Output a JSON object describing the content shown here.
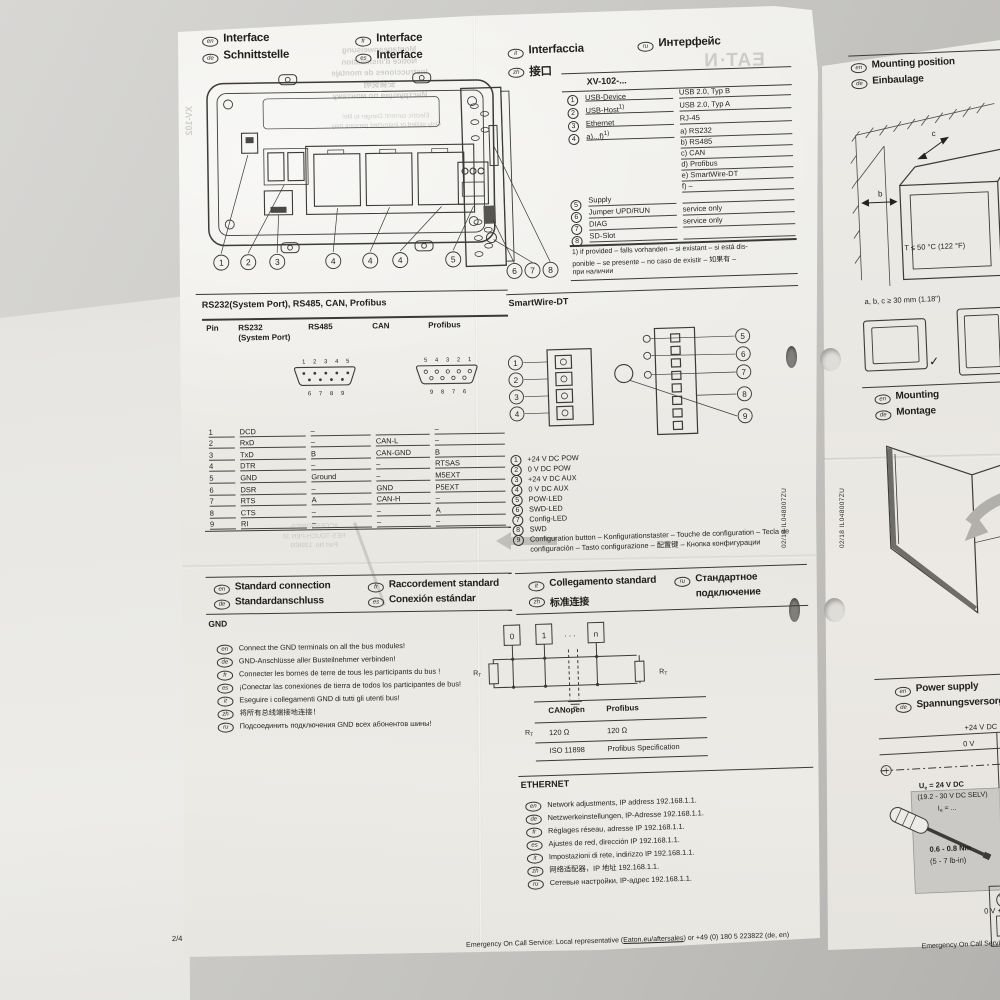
{
  "doc": {
    "code": "02/18 IL048007ZU",
    "page": "2/4",
    "footer": {
      "pre": "Emergency On Call Service: Local representative (",
      "link": "Eaton.eu/aftersales",
      "post": ") or +49 (0) 180 5 223822 (de, en)",
      "right_partial": "Emergency On Call Service: Lo"
    }
  },
  "interface_left": {
    "headers": [
      {
        "lang": "en",
        "text": "Interface"
      },
      {
        "lang": "de",
        "text": "Schnittstelle"
      },
      {
        "lang": "fr",
        "text": "Interface"
      },
      {
        "lang": "es",
        "text": "Interface"
      }
    ],
    "callouts": [
      "1",
      "2",
      "3",
      "4",
      "4",
      "4",
      "5"
    ]
  },
  "interface_mid": {
    "headers": [
      {
        "lang": "it",
        "text": "Interfaccia"
      },
      {
        "lang": "zh",
        "text": "接口"
      },
      {
        "lang": "ru",
        "text": "Интерфейс"
      }
    ],
    "side_callouts": [
      "6",
      "7",
      "8"
    ]
  },
  "xv102": {
    "title": "XV-102-...",
    "rows": [
      {
        "num": "1",
        "label": "USB-Device",
        "sup": "",
        "value": "USB 2.0, Typ B"
      },
      {
        "num": "2",
        "label": "USB-Host",
        "sup": "1)",
        "value": "USB 2.0, Typ A"
      },
      {
        "num": "3",
        "label": "Ethernet",
        "sup": "",
        "value": "RJ-45"
      },
      {
        "num": "4",
        "label": "a)...f)",
        "sup": "1)",
        "value": ""
      },
      {
        "num": "5",
        "label": "Supply",
        "sup": "",
        "value": ""
      },
      {
        "num": "6",
        "label": "Jumper UPD/RUN",
        "sup": "",
        "value": "service only"
      },
      {
        "num": "7",
        "label": "DIAG",
        "sup": "",
        "value": "service only"
      },
      {
        "num": "8",
        "label": "SD-Slot",
        "sup": "",
        "value": ""
      }
    ],
    "options": [
      "a) RS232",
      "b) RS485",
      "c) CAN",
      "d) Profibus",
      "e) SmartWire-DT",
      "f) –"
    ],
    "footnote_lines": [
      "1) if provided – falls vorhanden – si existant – si está dis-",
      "ponible – se presente – no caso de existir – 如果有 –",
      "при наличии"
    ]
  },
  "pin_table": {
    "title": "RS232(System Port), RS485, CAN, Profibus",
    "headers": {
      "pin": "Pin",
      "rs232a": "RS232",
      "rs232b": "(System Port)",
      "rs485": "RS485",
      "can": "CAN",
      "profibus": "Profibus"
    },
    "conn_left_top": [
      "1",
      "2",
      "3",
      "4",
      "5"
    ],
    "conn_left_bottom": [
      "6",
      "7",
      "8",
      "9"
    ],
    "conn_right_top": [
      "5",
      "4",
      "3",
      "2",
      "1"
    ],
    "conn_right_bottom": [
      "9",
      "8",
      "7",
      "6"
    ],
    "rows": [
      [
        "1",
        "DCD",
        "–",
        "",
        "–"
      ],
      [
        "2",
        "RxD",
        "–",
        "CAN-L",
        "–"
      ],
      [
        "3",
        "TxD",
        "B",
        "CAN-GND",
        "B"
      ],
      [
        "4",
        "DTR",
        "–",
        "–",
        "RTSAS"
      ],
      [
        "5",
        "GND",
        "Ground",
        "–",
        "M5EXT"
      ],
      [
        "6",
        "DSR",
        "–",
        "GND",
        "P5EXT"
      ],
      [
        "7",
        "RTS",
        "A",
        "CAN-H",
        "–"
      ],
      [
        "8",
        "CTS",
        "–",
        "–",
        "A"
      ],
      [
        "9",
        "RI",
        "–",
        "–",
        "–"
      ]
    ]
  },
  "smartwire": {
    "title": "SmartWire-DT",
    "left_callouts": [
      "1",
      "2",
      "3",
      "4"
    ],
    "right_callouts": [
      "5",
      "6",
      "7",
      "8",
      "9"
    ],
    "legend": [
      {
        "num": "1",
        "text": "+24 V DC POW"
      },
      {
        "num": "2",
        "text": "0 V DC POW"
      },
      {
        "num": "3",
        "text": "+24 V DC AUX"
      },
      {
        "num": "4",
        "text": "0 V DC AUX"
      },
      {
        "num": "5",
        "text": "POW-LED"
      },
      {
        "num": "6",
        "text": "SWD-LED"
      },
      {
        "num": "7",
        "text": "Config-LED"
      },
      {
        "num": "8",
        "text": "SWD"
      },
      {
        "num": "9",
        "text": "Configuration button – Konfigurationstaster – Touche de configuration – Tecla de configuración – Tasto configurazione – 配置键 – Кнопка конфигурации"
      }
    ]
  },
  "std_conn_left": {
    "headers": [
      {
        "lang": "en",
        "text": "Standard connection"
      },
      {
        "lang": "de",
        "text": "Standardanschluss"
      },
      {
        "lang": "fr",
        "text": "Raccordement standard"
      },
      {
        "lang": "es",
        "text": "Conexión estándar"
      }
    ],
    "gnd": "GND",
    "items": [
      {
        "lang": "en",
        "text": "Connect the GND terminals on all the bus modules!"
      },
      {
        "lang": "de",
        "text": "GND-Anschlüsse aller Busteilnehmer verbinden!"
      },
      {
        "lang": "fr",
        "text": "Connecter les bornes de terre de tous les participants du bus !"
      },
      {
        "lang": "es",
        "text": "¡Conectar las conexiones de tierra de todos los participantes de bus!"
      },
      {
        "lang": "it",
        "text": "Eseguire i collegamenti GND di tutti gli utenti bus!"
      },
      {
        "lang": "zh",
        "text": "将所有总线端接地连接！"
      },
      {
        "lang": "ru",
        "text": "Подсоединить подключения GND всех абонентов шины!"
      }
    ]
  },
  "std_conn_mid": {
    "headers": [
      {
        "lang": "it",
        "text": "Collegamento standard",
        "text2": ""
      },
      {
        "lang": "zh",
        "text": "标准连接",
        "text2": ""
      },
      {
        "lang": "ru",
        "text": "Стандартное",
        "text2": "подключение"
      }
    ]
  },
  "bus": {
    "nodes": [
      "0",
      "1",
      "n"
    ],
    "dots": ". . .",
    "rt": {
      "base": "R",
      "sub": "T"
    },
    "table": {
      "col1": "CANopen",
      "col2": "Profibus",
      "r1c1": "120 Ω",
      "r1c2": "120 Ω",
      "r2c1": "ISO 11898",
      "r2c2": "Profibus Specification"
    }
  },
  "ethernet": {
    "title": "ETHERNET",
    "items": [
      {
        "lang": "en",
        "text": "Network adjustments, IP address 192.168.1.1."
      },
      {
        "lang": "de",
        "text": "Netzwerkeinstellungen, IP-Adresse 192.168.1.1."
      },
      {
        "lang": "fr",
        "text": "Réglages réseau, adresse IP 192.168.1.1."
      },
      {
        "lang": "es",
        "text": "Ajustes de red, dirección IP 192.168.1.1."
      },
      {
        "lang": "it",
        "text": "Impostazioni di rete, indirizzo IP 192.168.1.1."
      },
      {
        "lang": "zh",
        "text": "网络适配器，IP 地址 192.168.1.1."
      },
      {
        "lang": "ru",
        "text": "Сетевые настройки, IP-адрес 192.168.1.1."
      }
    ]
  },
  "mounting_pos": {
    "headers": [
      {
        "lang": "en",
        "text": "Mounting position"
      },
      {
        "lang": "de",
        "text": "Einbaulage"
      }
    ],
    "temp": "T ≤ 50 °C (122 °F)",
    "dims": "a, b, c ≥ 30 mm (1.18\")",
    "label_b": "b",
    "label_c": "c",
    "check": "✓"
  },
  "mounting": {
    "headers": [
      {
        "lang": "en",
        "text": "Mounting"
      },
      {
        "lang": "de",
        "text": "Montage"
      }
    ]
  },
  "power": {
    "headers": [
      {
        "lang": "en",
        "text": "Power supply"
      },
      {
        "lang": "de",
        "text": "Spannungsversorgung"
      }
    ],
    "v24": "+24 V DC",
    "v0": "0 V",
    "ue": {
      "base": "U",
      "sub": "e",
      "rest": " = 24 V DC"
    },
    "ue2": "(19.2 - 30 V DC SELV)",
    "ie": {
      "base": "I",
      "sub": "e",
      "rest": " = ..."
    },
    "torque": "0.6 - 0.8 Nm",
    "torque2": "(5 - 7 lb-in)",
    "v0plus": "0 V +"
  },
  "bleed": {
    "top_lines": [
      "Montageanweisung",
      "Notice d'installation",
      "Instrucciones de montaje",
      "安装说明",
      "Инструкция по монтажу"
    ],
    "warn1": "Electric current! Danger to life!",
    "warn2": "Only skilled or instructed persons may",
    "logo": "EAT·N",
    "model": "XV-102",
    "acc1": "ACCESSORIES-",
    "acc2": "RES-TOUCH-PEN 10",
    "acc3": "Part No. 139809"
  }
}
